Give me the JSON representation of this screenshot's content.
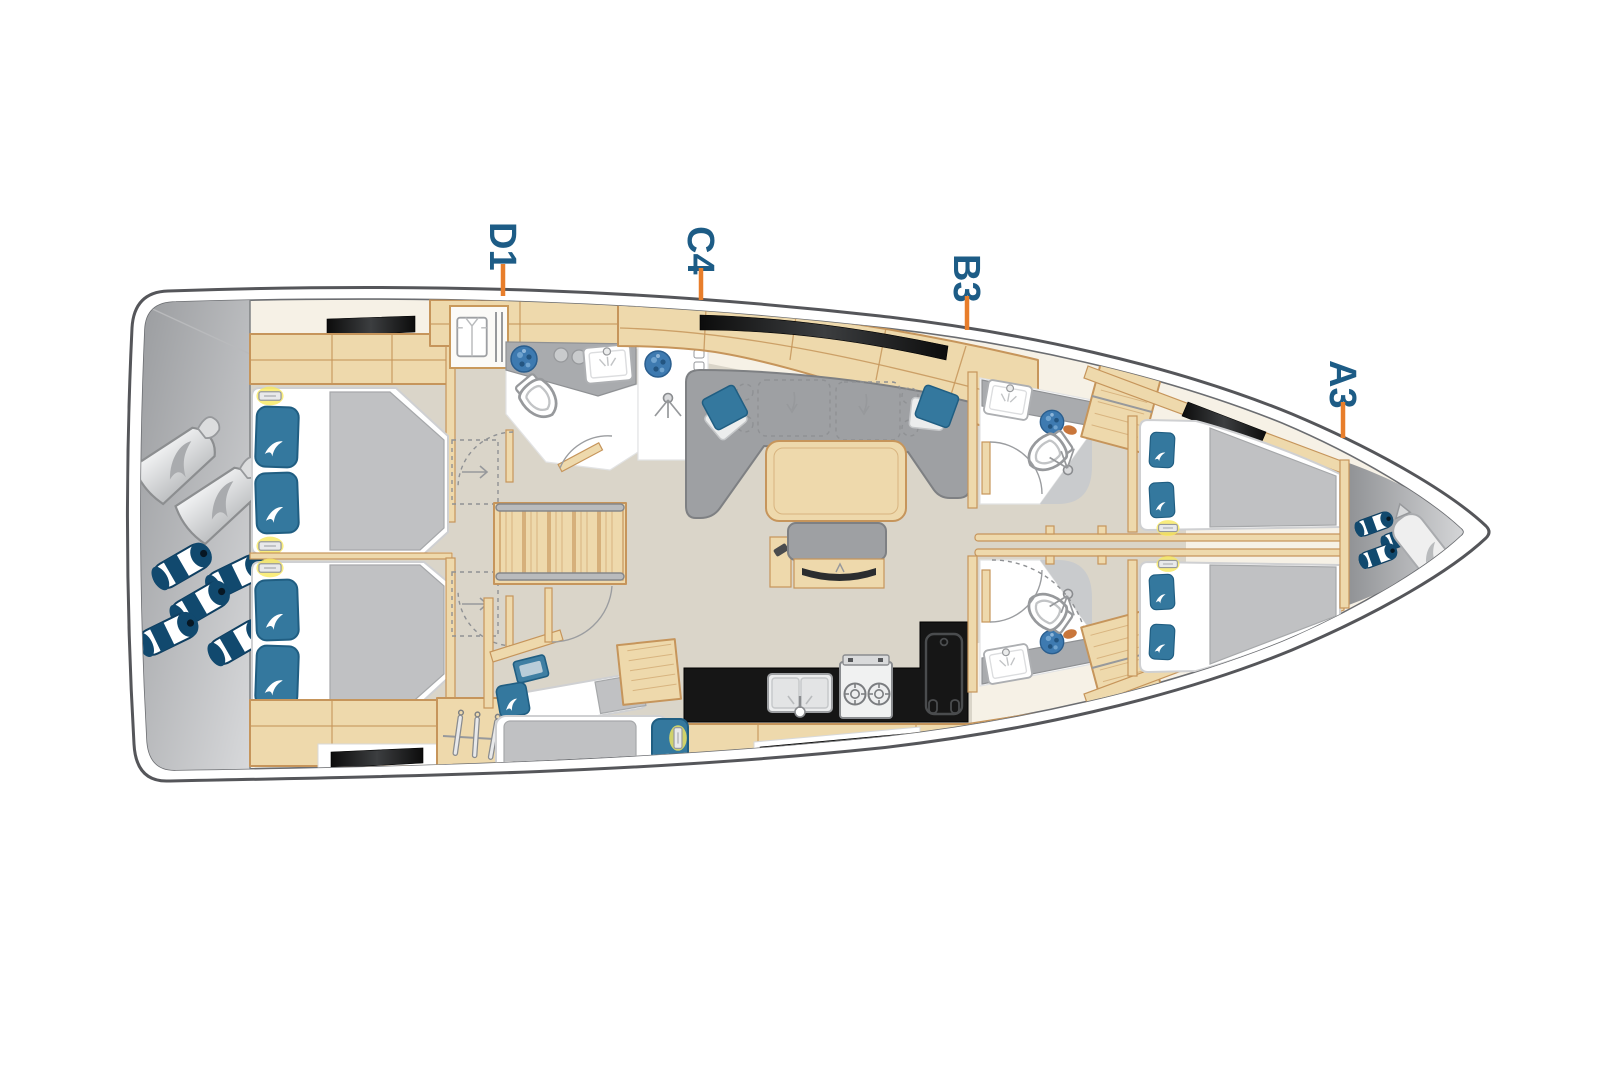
{
  "diagram": {
    "type": "yacht-deck-plan",
    "description": "Sailing yacht interior layout plan, side-on top view, bow to the right",
    "cabin_markers": [
      {
        "id": "D1",
        "zone": "aft"
      },
      {
        "id": "C4",
        "zone": "aft-mid"
      },
      {
        "id": "B3",
        "zone": "mid"
      },
      {
        "id": "A3",
        "zone": "bow"
      }
    ]
  },
  "colors": {
    "hull-line": "#55565A",
    "deck": "#F6F1E6",
    "floor": "#DAD5C9",
    "wood": "#EED9AC",
    "wood-stroke": "#C6955B",
    "furn": "#9EA0A3",
    "furn-dark": "#7E8083",
    "mattress": "#C0C1C3",
    "pillow": "#34789E",
    "pillow-stroke": "#205E82",
    "counter": "#A9ABAE",
    "navy": "#11496E",
    "mosaic": "#3E7AB0",
    "glow": "#F7E85E",
    "marker": "#1D5C86",
    "tick": "#E87E2B",
    "outline": "#97999C"
  }
}
